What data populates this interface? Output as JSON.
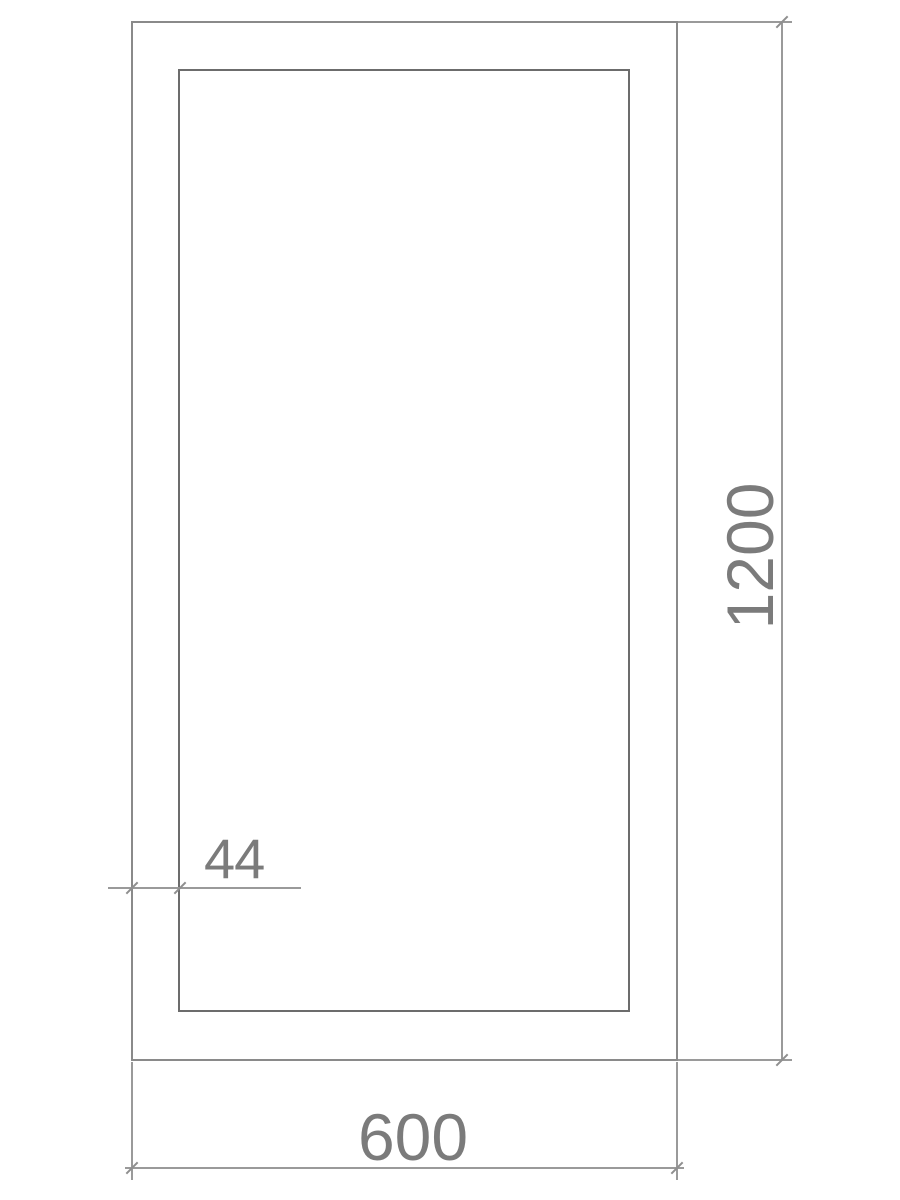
{
  "drawing": {
    "labels": {
      "width": "600",
      "height": "1200",
      "frame_thickness": "44"
    },
    "colors": {
      "background": "#ffffff",
      "outer_rect_line": "#8a8a8a",
      "inner_rect_line": "#6c6c6c",
      "dimension_line": "#9a9a9a",
      "tick": "#8f8f8f",
      "label_text": "#7b7b7b"
    }
  }
}
